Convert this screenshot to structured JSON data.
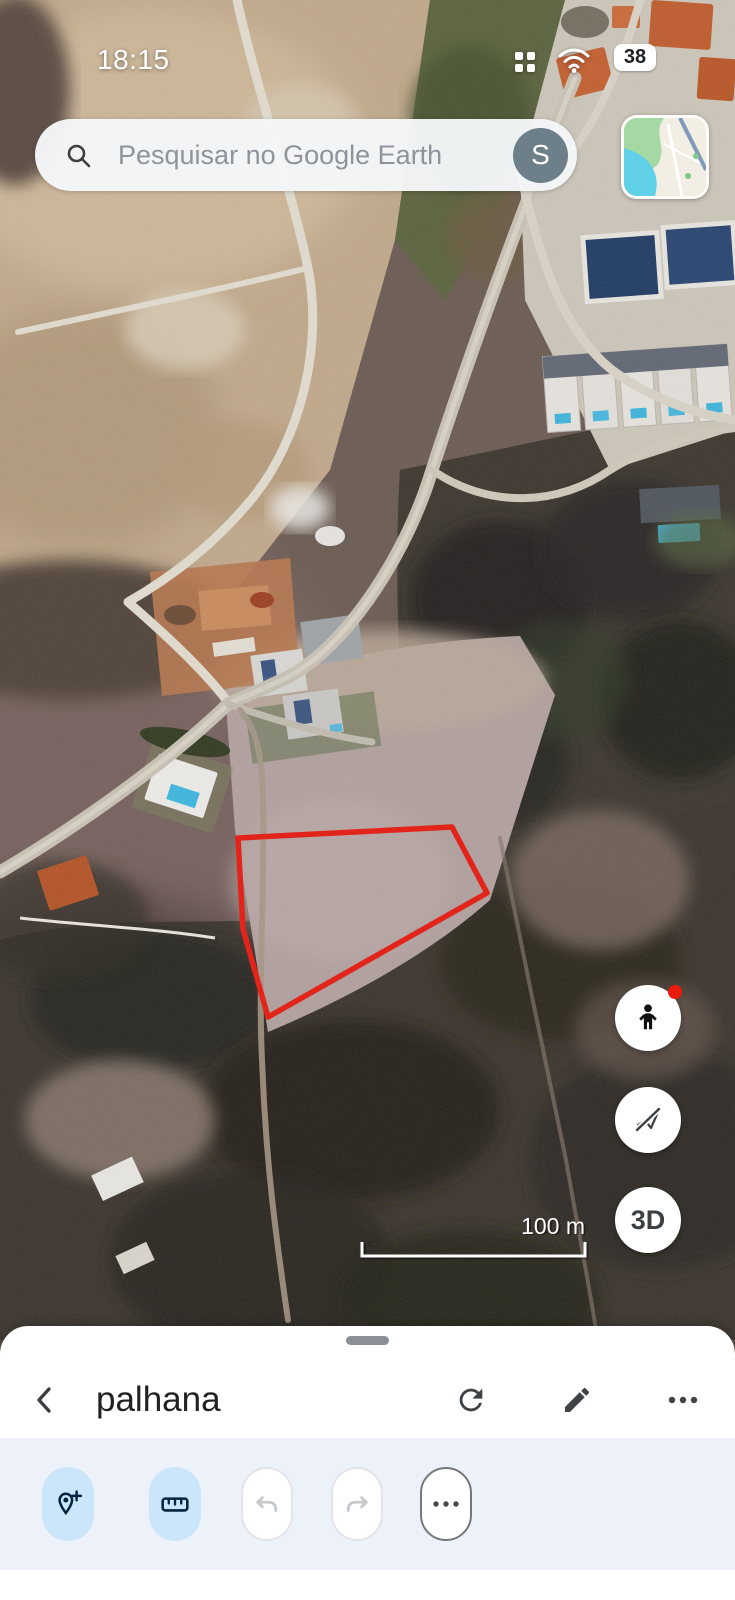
{
  "status_bar": {
    "time": "18:15",
    "battery_percent": "38"
  },
  "search": {
    "placeholder": "Pesquisar no Google Earth",
    "account_initial": "S"
  },
  "map": {
    "scale_label": "100 m",
    "polygon_points": "238,838 452,827 487,893 268,1017 243,929",
    "polygon_color": "#e2241b"
  },
  "controls": {
    "threed_label": "3D"
  },
  "bottom_sheet": {
    "title": "palhana"
  },
  "icons": {
    "status": [
      "app-grid",
      "wifi",
      "battery"
    ],
    "search": "magnifier",
    "account": "letter-avatar",
    "map_controls": [
      "pegman",
      "flight-off",
      "3d"
    ],
    "sheet_header": [
      "back-chevron",
      "refresh",
      "edit-pencil",
      "overflow-dots"
    ],
    "toolbar": [
      "add-placemark",
      "measure-ruler",
      "undo",
      "redo",
      "more-dots"
    ]
  }
}
